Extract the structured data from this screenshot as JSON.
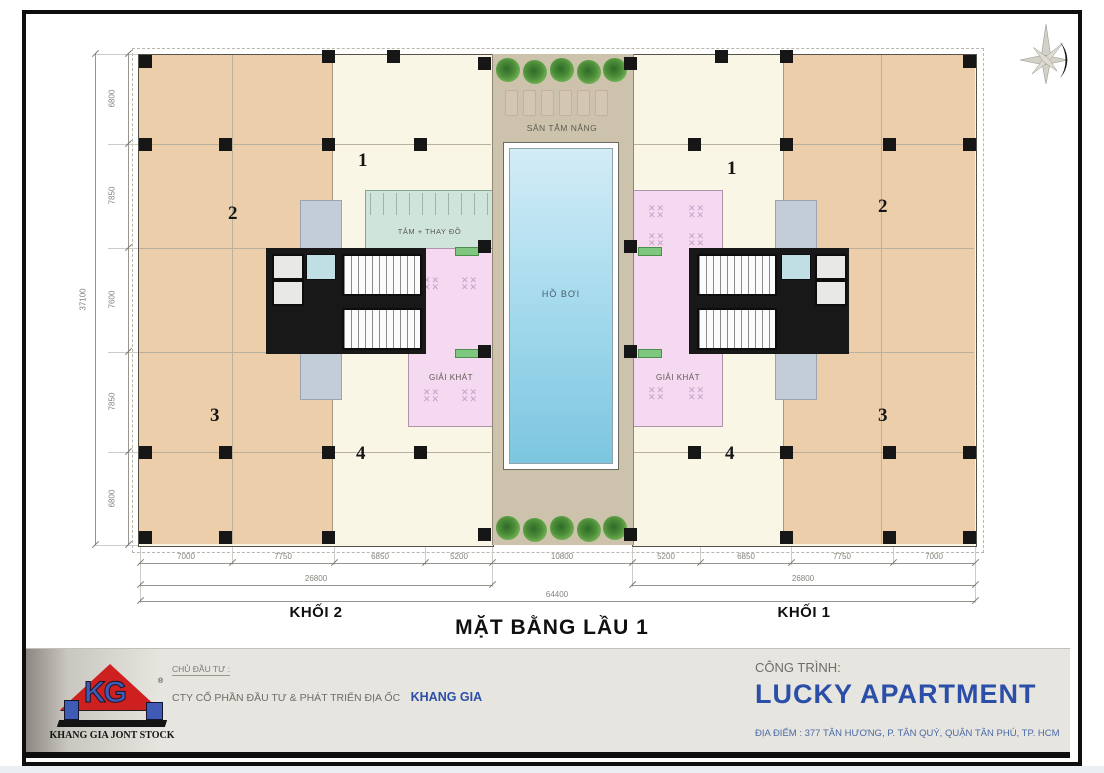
{
  "plan": {
    "title": "MẶT BẰNG LẦU 1",
    "blocks": {
      "left_label": "KHỐI 2",
      "right_label": "KHỐI 1"
    },
    "rooms": {
      "sun_deck": "SÂN TẮM NẮNG",
      "pool": "HỒ BƠI",
      "changing": "TẮM + THAY ĐỒ",
      "refreshment": "GIẢI KHÁT"
    },
    "units_left": [
      "1",
      "2",
      "3",
      "4"
    ],
    "units_right": [
      "1",
      "2",
      "3",
      "4"
    ],
    "dimensions": {
      "vertical_segments": [
        "6800",
        "7850",
        "7600",
        "7850",
        "6800"
      ],
      "vertical_total": "37100",
      "bottom_segments": [
        "7000",
        "7750",
        "6850",
        "5200",
        "10800",
        "5200",
        "6850",
        "7750",
        "7000"
      ],
      "bottom_half_left": "26800",
      "bottom_half_right": "26800",
      "bottom_total": "64400"
    },
    "compass": "compass-rose-east"
  },
  "footer": {
    "investor_label": "CHỦ ĐẦU TƯ :",
    "investor_company": "CTY CỔ PHẦN ĐẦU TƯ & PHÁT TRIỂN ĐỊA ỐC",
    "investor_name": "KHANG GIA",
    "logo_caption": "KHANG GIA JONT STOCK",
    "project_label": "CÔNG TRÌNH:",
    "project_name": "LUCKY APARTMENT",
    "project_address": "ĐỊA ĐIỂM : 377 TÂN HƯƠNG, P. TÂN QUÝ, QUẬN TÂN PHÚ, TP. HCM"
  },
  "colors": {
    "accent_blue": "#2b4fa8",
    "logo_red": "#cf2020",
    "unit_tan": "#ecceaa",
    "unit_cream": "#f9f6e5",
    "deck_taupe": "#cdc3ac",
    "pool_blue": "#7cc6e0",
    "refreshment_pink": "#f4d9f1",
    "changing_teal": "#cfe5dc",
    "planter_green": "#7ec77e"
  }
}
